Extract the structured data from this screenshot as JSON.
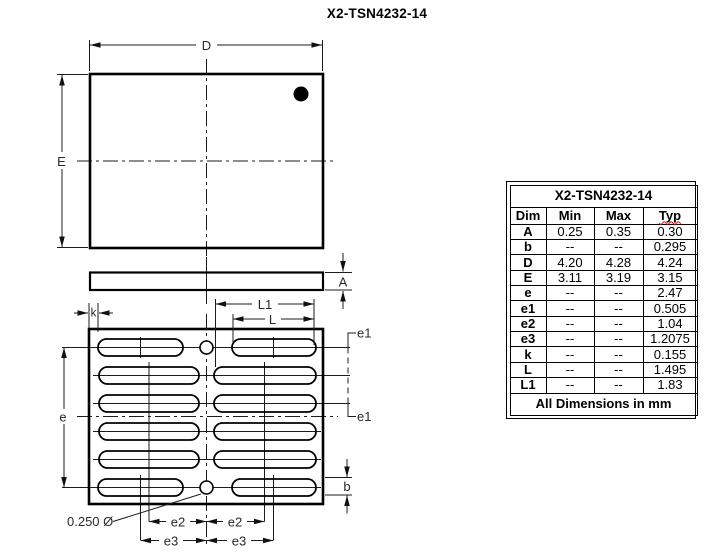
{
  "page_title": "X2-TSN4232-14",
  "drawing": {
    "labels": {
      "D": "D",
      "E": "E",
      "A": "A",
      "k": "k",
      "L1": "L1",
      "L": "L",
      "e": "e",
      "e1_top": "e1",
      "e1_bottom": "e1",
      "e2_left": "e2",
      "e2_right": "e2",
      "e3_left": "e3",
      "e3_right": "e3",
      "b": "b",
      "pin1_hole_callout": "0.250 Ø"
    }
  },
  "table": {
    "title": "X2-TSN4232-14",
    "columns": {
      "dim": "Dim",
      "min": "Min",
      "max": "Max",
      "typ": "Typ"
    },
    "rows": [
      {
        "dim": "A",
        "min": "0.25",
        "max": "0.35",
        "typ": "0.30"
      },
      {
        "dim": "b",
        "min": "--",
        "max": "--",
        "typ": "0.295"
      },
      {
        "dim": "D",
        "min": "4.20",
        "max": "4.28",
        "typ": "4.24"
      },
      {
        "dim": "E",
        "min": "3.11",
        "max": "3.19",
        "typ": "3.15"
      },
      {
        "dim": "e",
        "min": "--",
        "max": "--",
        "typ": "2.47"
      },
      {
        "dim": "e1",
        "min": "--",
        "max": "--",
        "typ": "0.505"
      },
      {
        "dim": "e2",
        "min": "--",
        "max": "--",
        "typ": "1.04"
      },
      {
        "dim": "e3",
        "min": "--",
        "max": "--",
        "typ": "1.2075"
      },
      {
        "dim": "k",
        "min": "--",
        "max": "--",
        "typ": "0.155"
      },
      {
        "dim": "L",
        "min": "--",
        "max": "--",
        "typ": "1.495"
      },
      {
        "dim": "L1",
        "min": "--",
        "max": "--",
        "typ": "1.83"
      }
    ],
    "footer": "All Dimensions in mm"
  }
}
